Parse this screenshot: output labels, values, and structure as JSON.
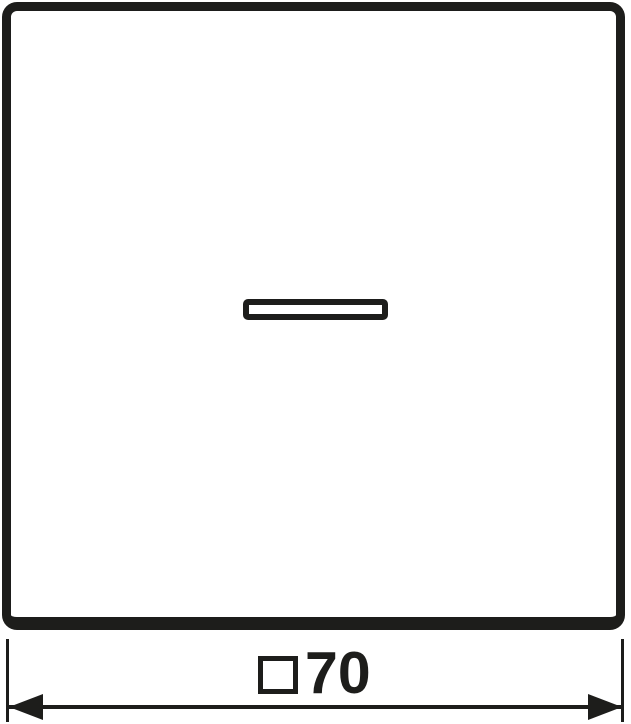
{
  "colors": {
    "ink": "#1d1d1b",
    "background": "#ffffff"
  },
  "drawing": {
    "dimension": {
      "label": "□70",
      "symbol": "□",
      "value": "70"
    }
  }
}
